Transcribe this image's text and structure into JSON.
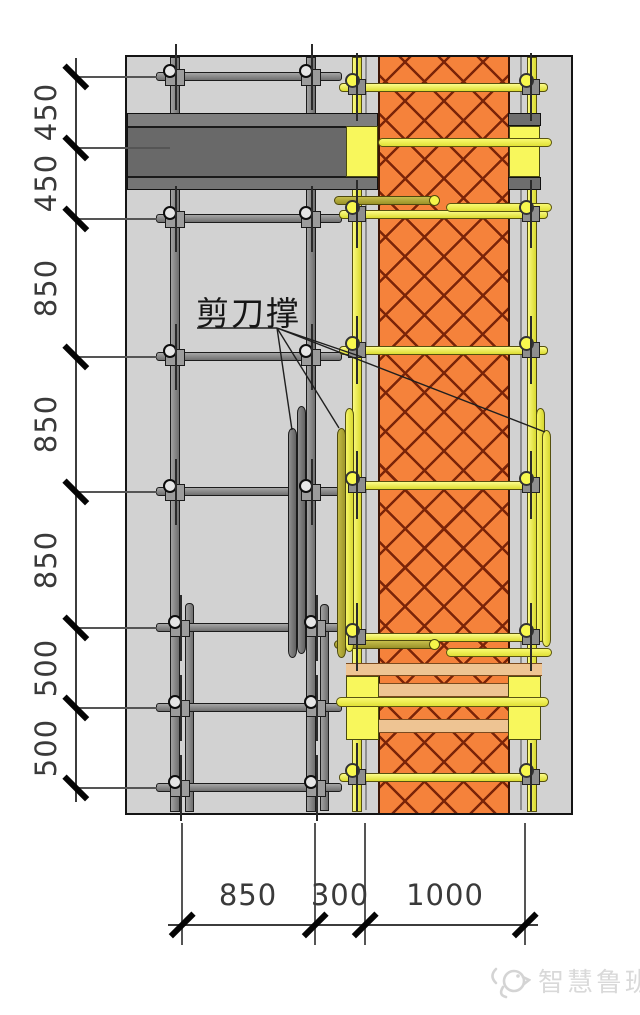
{
  "drawing": {
    "annotation_label": "剪刀撑",
    "dim_left": [
      "450",
      "450",
      "850",
      "850",
      "850",
      "500",
      "500"
    ],
    "dim_bottom": [
      "850",
      "300",
      "1000"
    ],
    "watermark": "智慧鲁班",
    "colors": {
      "wall_concrete": "#d2d2d2",
      "column_fill": "#f5823b",
      "hatch_line": "#7b2408",
      "scaffold_gray": "#8a8a8a",
      "scaffold_yellow": "#f5f549",
      "tie_olive": "#a89f2e",
      "beam_gray": "#6d6d6d",
      "timber_tan": "#eec493"
    }
  }
}
